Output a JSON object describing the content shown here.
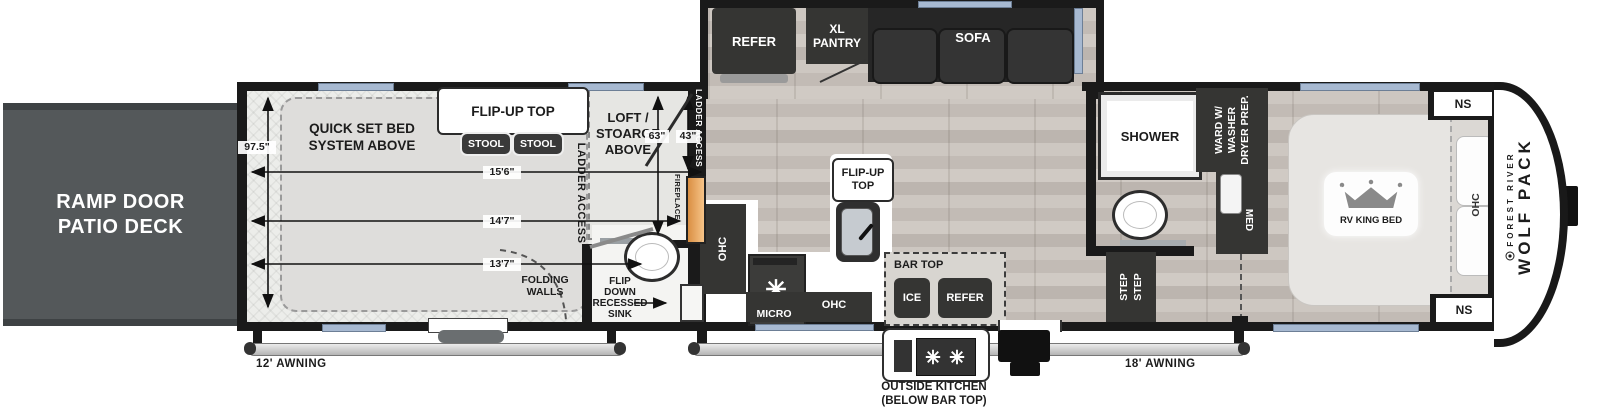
{
  "colors": {
    "wall": "#1a1a1a",
    "deck": "#54585a",
    "window": "#a7b9d1",
    "appliance": "#353533",
    "fireplace": "#eda75c",
    "floor-light": "#ecedea",
    "counter": "#ffffff"
  },
  "deck": {
    "label": "RAMP DOOR\nPATIO DECK"
  },
  "garage": {
    "bed_above": "QUICK SET BED\nSYSTEM ABOVE",
    "flip_up_top": "FLIP-UP TOP",
    "stools": [
      "STOOL",
      "STOOL"
    ],
    "height": "97.5\"",
    "len_a": "15'6\"",
    "len_b": "14'7\"",
    "len_c": "13'7\"",
    "ladder_access": "LADDER ACCESS",
    "loft": "LOFT /\nSTOARGE\nABOVE",
    "loft_h": "63\"",
    "loft_w": "43\"",
    "wall_ladder_access": "LADDER ACCESS",
    "fireplace": "FIREPLACE",
    "folding_walls": "FOLDING\nWALLS",
    "flip_sink": "FLIP\nDOWN\nRECESSED\nSINK"
  },
  "slideout": {
    "refer": "REFER",
    "pantry": "XL\nPANTRY",
    "sofa": "SOFA"
  },
  "kitchen": {
    "flip_up_top": "FLIP-UP\nTOP",
    "ohc_wall": "OHC",
    "micro": "MICRO",
    "ohc_base": "OHC",
    "bar_top": "BAR TOP",
    "ice": "ICE",
    "refer": "REFER",
    "outside_kitchen": "OUTSIDE KITCHEN\n(BELOW BAR TOP)"
  },
  "bath": {
    "shower": "SHOWER",
    "wardrobe": "WARD W/\nWASHER\nDRYER PREP.",
    "med": "MED",
    "steps": "STEP\nSTEP"
  },
  "bedroom": {
    "bed": "RV KING BED",
    "ohc": "OHC",
    "ns_front": "NS",
    "ns_rear": "NS"
  },
  "brand": {
    "maker": "FOREST RIVER",
    "model": "WOLF PACK"
  },
  "awning_left": "12' AWNING",
  "awning_right": "18' AWNING"
}
